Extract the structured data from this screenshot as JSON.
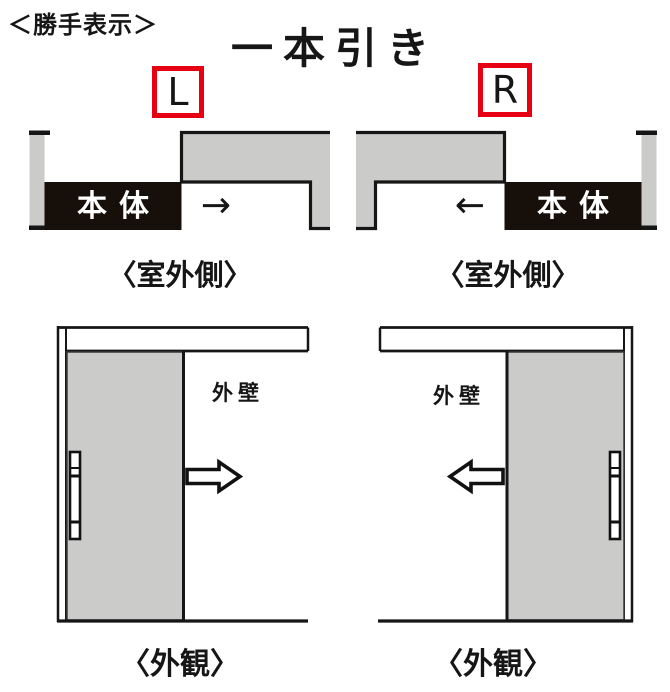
{
  "page": {
    "handing_note": "＜勝手表示＞",
    "title": "一本引き"
  },
  "colors": {
    "accent_red": "#e60012",
    "wall_gray": "#cbcbc9",
    "panel_black": "#17100a",
    "line_black": "#161616"
  },
  "left_diagram": {
    "handing_label": "L",
    "plan": {
      "panel_label": "本体",
      "slide_arrow": "→",
      "caption": "〈室外側〉"
    },
    "elevation": {
      "wall_label": "外壁",
      "caption": "〈外観〉"
    }
  },
  "right_diagram": {
    "handing_label": "R",
    "plan": {
      "panel_label": "本体",
      "slide_arrow": "←",
      "caption": "〈室外側〉"
    },
    "elevation": {
      "wall_label": "外壁",
      "caption": "〈外観〉"
    }
  }
}
